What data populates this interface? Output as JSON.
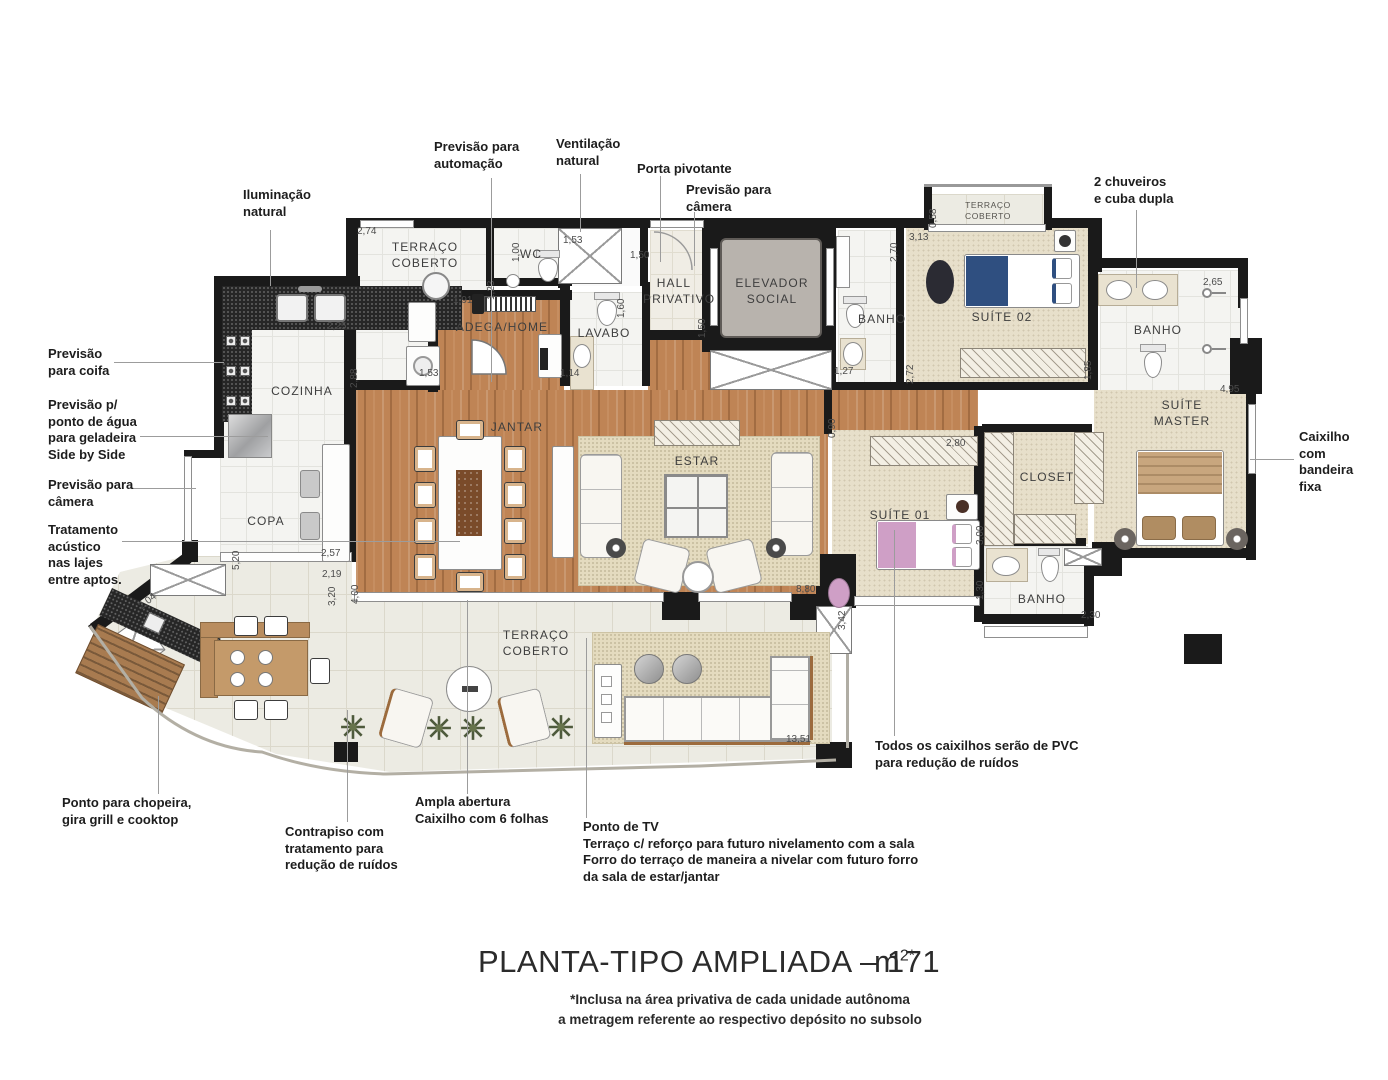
{
  "title": {
    "main": "PLANTA-TIPO AMPLIADA – 171",
    "unit": "m",
    "unit_sup": "2*",
    "footnote": "*Inclusa na área privativa de cada unidade autônoma\na metragem referente ao respectivo depósito no subsolo"
  },
  "rooms": {
    "terraco_servico": "TERRAÇO\nCOBERTO",
    "wc": "WC",
    "adega_home": "ADEGA/HOME",
    "lavabo": "LAVABO",
    "hall_privativo": "HALL\nPRIVATIVO",
    "elevador_social": "ELEVADOR\nSOCIAL",
    "banho_suite02": "BANHO",
    "terraco_suite02": "TERRAÇO\nCOBERTO",
    "suite02": "SUÍTE 02",
    "banho_master": "BANHO",
    "suite_master": "SUÍTE\nMASTER",
    "cozinha": "COZINHA",
    "copa": "COPA",
    "jantar": "JANTAR",
    "estar": "ESTAR",
    "suite01": "SUÍTE 01",
    "closet": "CLOSET",
    "banho_suite01": "BANHO",
    "terraco_principal": "TERRAÇO\nCOBERTO"
  },
  "callouts": {
    "iluminacao": "Iluminação\nnatural",
    "automacao": "Previsão para\nautomação",
    "ventilacao": "Ventilação\nnatural",
    "porta_pivotante": "Porta pivotante",
    "camera_hall": "Previsão para\ncâmera",
    "chuveiros": "2 chuveiros\ne cuba dupla",
    "coifa": "Previsão\npara coifa",
    "agua_geladeira": "Previsão p/\nponto de água\npara geladeira\nSide by Side",
    "camera_copa": "Previsão para\ncâmera",
    "acustico": "Tratamento\nacústico\nnas lajes\nentre aptos.",
    "caixilho_bandeira": "Caixilho\ncom\nbandeira\nfixa",
    "chopeira": "Ponto para chopeira,\ngira grill e cooktop",
    "contrapiso": "Contrapiso com\ntratamento para\nredução de ruídos",
    "ampla_abertura": "Ampla abertura\nCaixilho com 6 folhas",
    "ponto_tv": "Ponto de TV\nTerraço c/ reforço para futuro nivelamento com a sala\nForro do terraço de maneira a nivelar com futuro forro\nda sala de estar/jantar",
    "caixilhos_pvc": "Todos os caixilhos serão de PVC\npara redução de ruídos"
  },
  "dims": {
    "d01": "2,74",
    "d02": "1,00",
    "d03": "1,53",
    "d04": "1,50",
    "d05": "1,23",
    "d06": "1,91",
    "d07": "2,25",
    "d08": "2,88",
    "d09": "1,53",
    "d10": "1,14",
    "d11": "1,60",
    "d12": "1,50",
    "d13": "1,27",
    "d14": "2,70",
    "d15": "3,13",
    "d16": "0,58",
    "d17": "2,72",
    "d18": "1,85",
    "d19": "2,65",
    "d20": "4,95",
    "d21": "2,80",
    "d22": "3,00",
    "d23": "1,30",
    "d24": "2,30",
    "d25": "0,90",
    "d26": "8,80",
    "d27": "3,42",
    "d28": "5,20",
    "d29": "2,57",
    "d30": "2,19",
    "d31": "3,20",
    "d32": "4,00",
    "d33": "2,04",
    "d34": "13,51"
  },
  "colors": {
    "wall": "#1a1a1a",
    "wood": "#bf8455",
    "carpet": "#e7dfca",
    "tile": "#f4f4f1",
    "terrace_tile": "#ecebe3",
    "granite": "#262626",
    "bed_suite02": "#2f4f80",
    "bed_suite01": "#cf9fc6",
    "bed_master": "#c8a67e"
  }
}
